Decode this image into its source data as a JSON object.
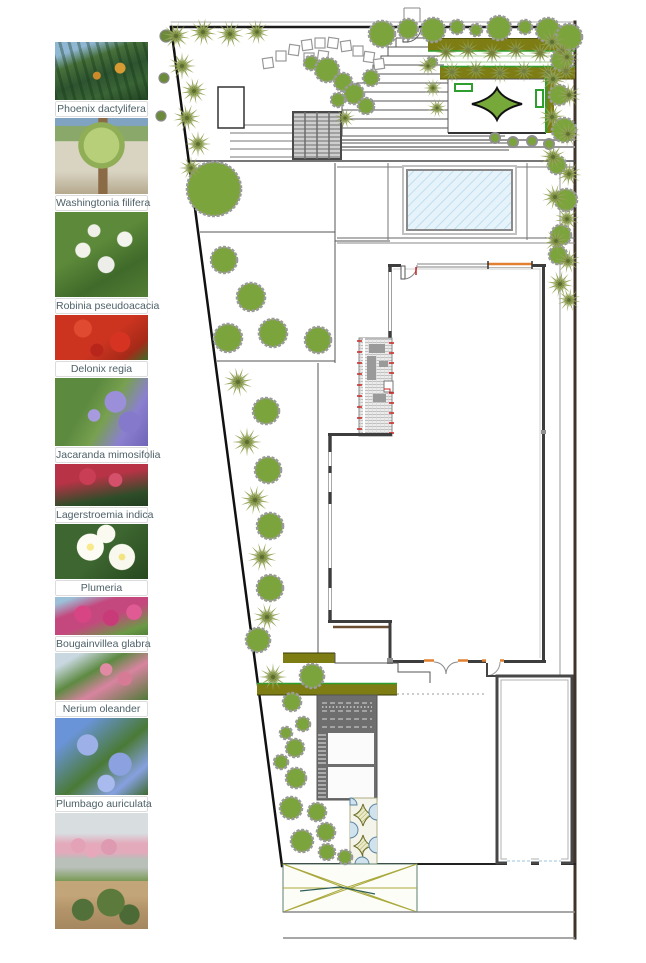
{
  "legend": {
    "items": [
      {
        "photo": "phoenix",
        "label": "Phoenix dactylifera"
      },
      {
        "photo": "washingtonia",
        "label": "Washingtonia filifera"
      },
      {
        "photo": "robinia",
        "label": "Robinia pseudoacacia"
      },
      {
        "photo": "delonix",
        "label": "Delonix regia"
      },
      {
        "photo": "jacaranda",
        "label": "Jacaranda mimosifolia"
      },
      {
        "photo": "lagerstroemia",
        "label": "Lagerstroemia indica"
      },
      {
        "photo": "plumeria",
        "label": "Plumeria"
      },
      {
        "photo": "bougainvillea",
        "label": "Bougainvillea glabra"
      },
      {
        "photo": "nerium",
        "label": "Nerium oleander"
      },
      {
        "photo": "plumbago",
        "label": "Plumbago auriculata"
      },
      {
        "photo": "pink-planter",
        "label": ""
      },
      {
        "photo": "shrub-mulch",
        "label": ""
      }
    ]
  },
  "plan": {
    "colors": {
      "tree_green": "#7ca43d",
      "palm_green": "#93a355",
      "palm_dark": "#7a8c42",
      "hedge_olive": "#7d7d14",
      "bright_green": "#2e9e2e",
      "diamond_green": "#76a83a",
      "pool_blue": "#e6f3fa",
      "accent_orange": "#e08030",
      "accent_red": "#cc2222"
    },
    "vegetation": {
      "trees": [
        [
          214,
          189,
          27
        ],
        [
          224,
          260,
          13
        ],
        [
          251,
          297,
          14
        ],
        [
          228,
          338,
          14
        ],
        [
          273,
          333,
          14
        ],
        [
          318,
          340,
          13
        ],
        [
          266,
          411,
          13
        ],
        [
          268,
          470,
          13
        ],
        [
          270,
          526,
          13
        ],
        [
          270,
          588,
          13
        ],
        [
          258,
          640,
          12
        ],
        [
          312,
          676,
          12
        ],
        [
          292,
          702,
          9
        ],
        [
          303,
          724,
          7
        ],
        [
          286,
          733,
          6
        ],
        [
          295,
          748,
          9
        ],
        [
          281,
          762,
          7
        ],
        [
          296,
          778,
          10
        ],
        [
          291,
          808,
          11
        ],
        [
          317,
          812,
          9
        ],
        [
          326,
          832,
          9
        ],
        [
          302,
          841,
          11
        ],
        [
          327,
          852,
          8
        ],
        [
          345,
          857,
          7
        ],
        [
          382,
          34,
          13
        ],
        [
          408,
          29,
          10
        ],
        [
          433,
          30,
          12
        ],
        [
          457,
          27,
          7
        ],
        [
          476,
          30,
          6
        ],
        [
          499,
          28,
          12
        ],
        [
          525,
          27,
          7
        ],
        [
          548,
          30,
          12
        ],
        [
          569,
          37,
          13
        ],
        [
          311,
          63,
          7
        ],
        [
          327,
          70,
          12
        ],
        [
          343,
          82,
          9
        ],
        [
          354,
          94,
          10
        ],
        [
          338,
          100,
          7
        ],
        [
          366,
          106,
          8
        ],
        [
          371,
          78,
          8
        ],
        [
          432,
          62,
          5
        ],
        [
          562,
          60,
          11
        ],
        [
          559,
          95,
          10
        ],
        [
          564,
          130,
          12
        ],
        [
          557,
          165,
          9
        ],
        [
          566,
          200,
          11
        ],
        [
          561,
          235,
          10
        ],
        [
          558,
          255,
          9
        ]
      ],
      "palms": [
        [
          176,
          36,
          1,
          10
        ],
        [
          203,
          32,
          1,
          40
        ],
        [
          230,
          34,
          1,
          70
        ],
        [
          257,
          32,
          0.9,
          20
        ],
        [
          182,
          66,
          1,
          0
        ],
        [
          194,
          91,
          0.95,
          50
        ],
        [
          187,
          118,
          1,
          80
        ],
        [
          198,
          144,
          0.95,
          30
        ],
        [
          191,
          168,
          0.85,
          60
        ],
        [
          238,
          382,
          1.05,
          20
        ],
        [
          247,
          442,
          1.05,
          60
        ],
        [
          255,
          500,
          1.05,
          10
        ],
        [
          262,
          557,
          1.05,
          45
        ],
        [
          267,
          617,
          1,
          75
        ],
        [
          273,
          677,
          1,
          30
        ],
        [
          552,
          42,
          0.95,
          15
        ],
        [
          567,
          57,
          0.9,
          45
        ],
        [
          553,
          79,
          0.95,
          75
        ],
        [
          569,
          95,
          0.9,
          25
        ],
        [
          552,
          117,
          0.95,
          55
        ],
        [
          568,
          134,
          0.9,
          5
        ],
        [
          553,
          157,
          0.95,
          65
        ],
        [
          569,
          174,
          0.9,
          35
        ],
        [
          555,
          197,
          0.95,
          15
        ],
        [
          567,
          219,
          0.9,
          50
        ],
        [
          556,
          241,
          0.9,
          20
        ],
        [
          568,
          261,
          0.9,
          70
        ],
        [
          560,
          284,
          0.95,
          40
        ],
        [
          569,
          300,
          0.85,
          10
        ],
        [
          428,
          66,
          0.75,
          30
        ],
        [
          433,
          88,
          0.7,
          60
        ],
        [
          437,
          108,
          0.7,
          15
        ],
        [
          345,
          118,
          0.75,
          45
        ]
      ],
      "hedge_palms": [
        [
          446,
          52
        ],
        [
          468,
          50
        ],
        [
          492,
          53
        ],
        [
          516,
          50
        ],
        [
          540,
          53
        ],
        [
          562,
          51
        ],
        [
          452,
          72
        ],
        [
          476,
          70
        ],
        [
          500,
          73
        ],
        [
          524,
          71
        ],
        [
          548,
          73
        ],
        [
          566,
          71
        ]
      ],
      "small_circles": [
        [
          166,
          36,
          6
        ],
        [
          164,
          78,
          5
        ],
        [
          161,
          116,
          5
        ]
      ],
      "shrub_dots": [
        [
          495,
          138,
          5
        ],
        [
          513,
          142,
          5
        ],
        [
          532,
          141,
          5
        ],
        [
          549,
          144,
          5
        ]
      ],
      "stepping_stones": [
        [
          268,
          63
        ],
        [
          281,
          56
        ],
        [
          294,
          50
        ],
        [
          307,
          45
        ],
        [
          320,
          43
        ],
        [
          333,
          43
        ],
        [
          346,
          46
        ],
        [
          358,
          51
        ],
        [
          369,
          57
        ],
        [
          379,
          64
        ],
        [
          309,
          58
        ],
        [
          323,
          56
        ]
      ]
    }
  }
}
